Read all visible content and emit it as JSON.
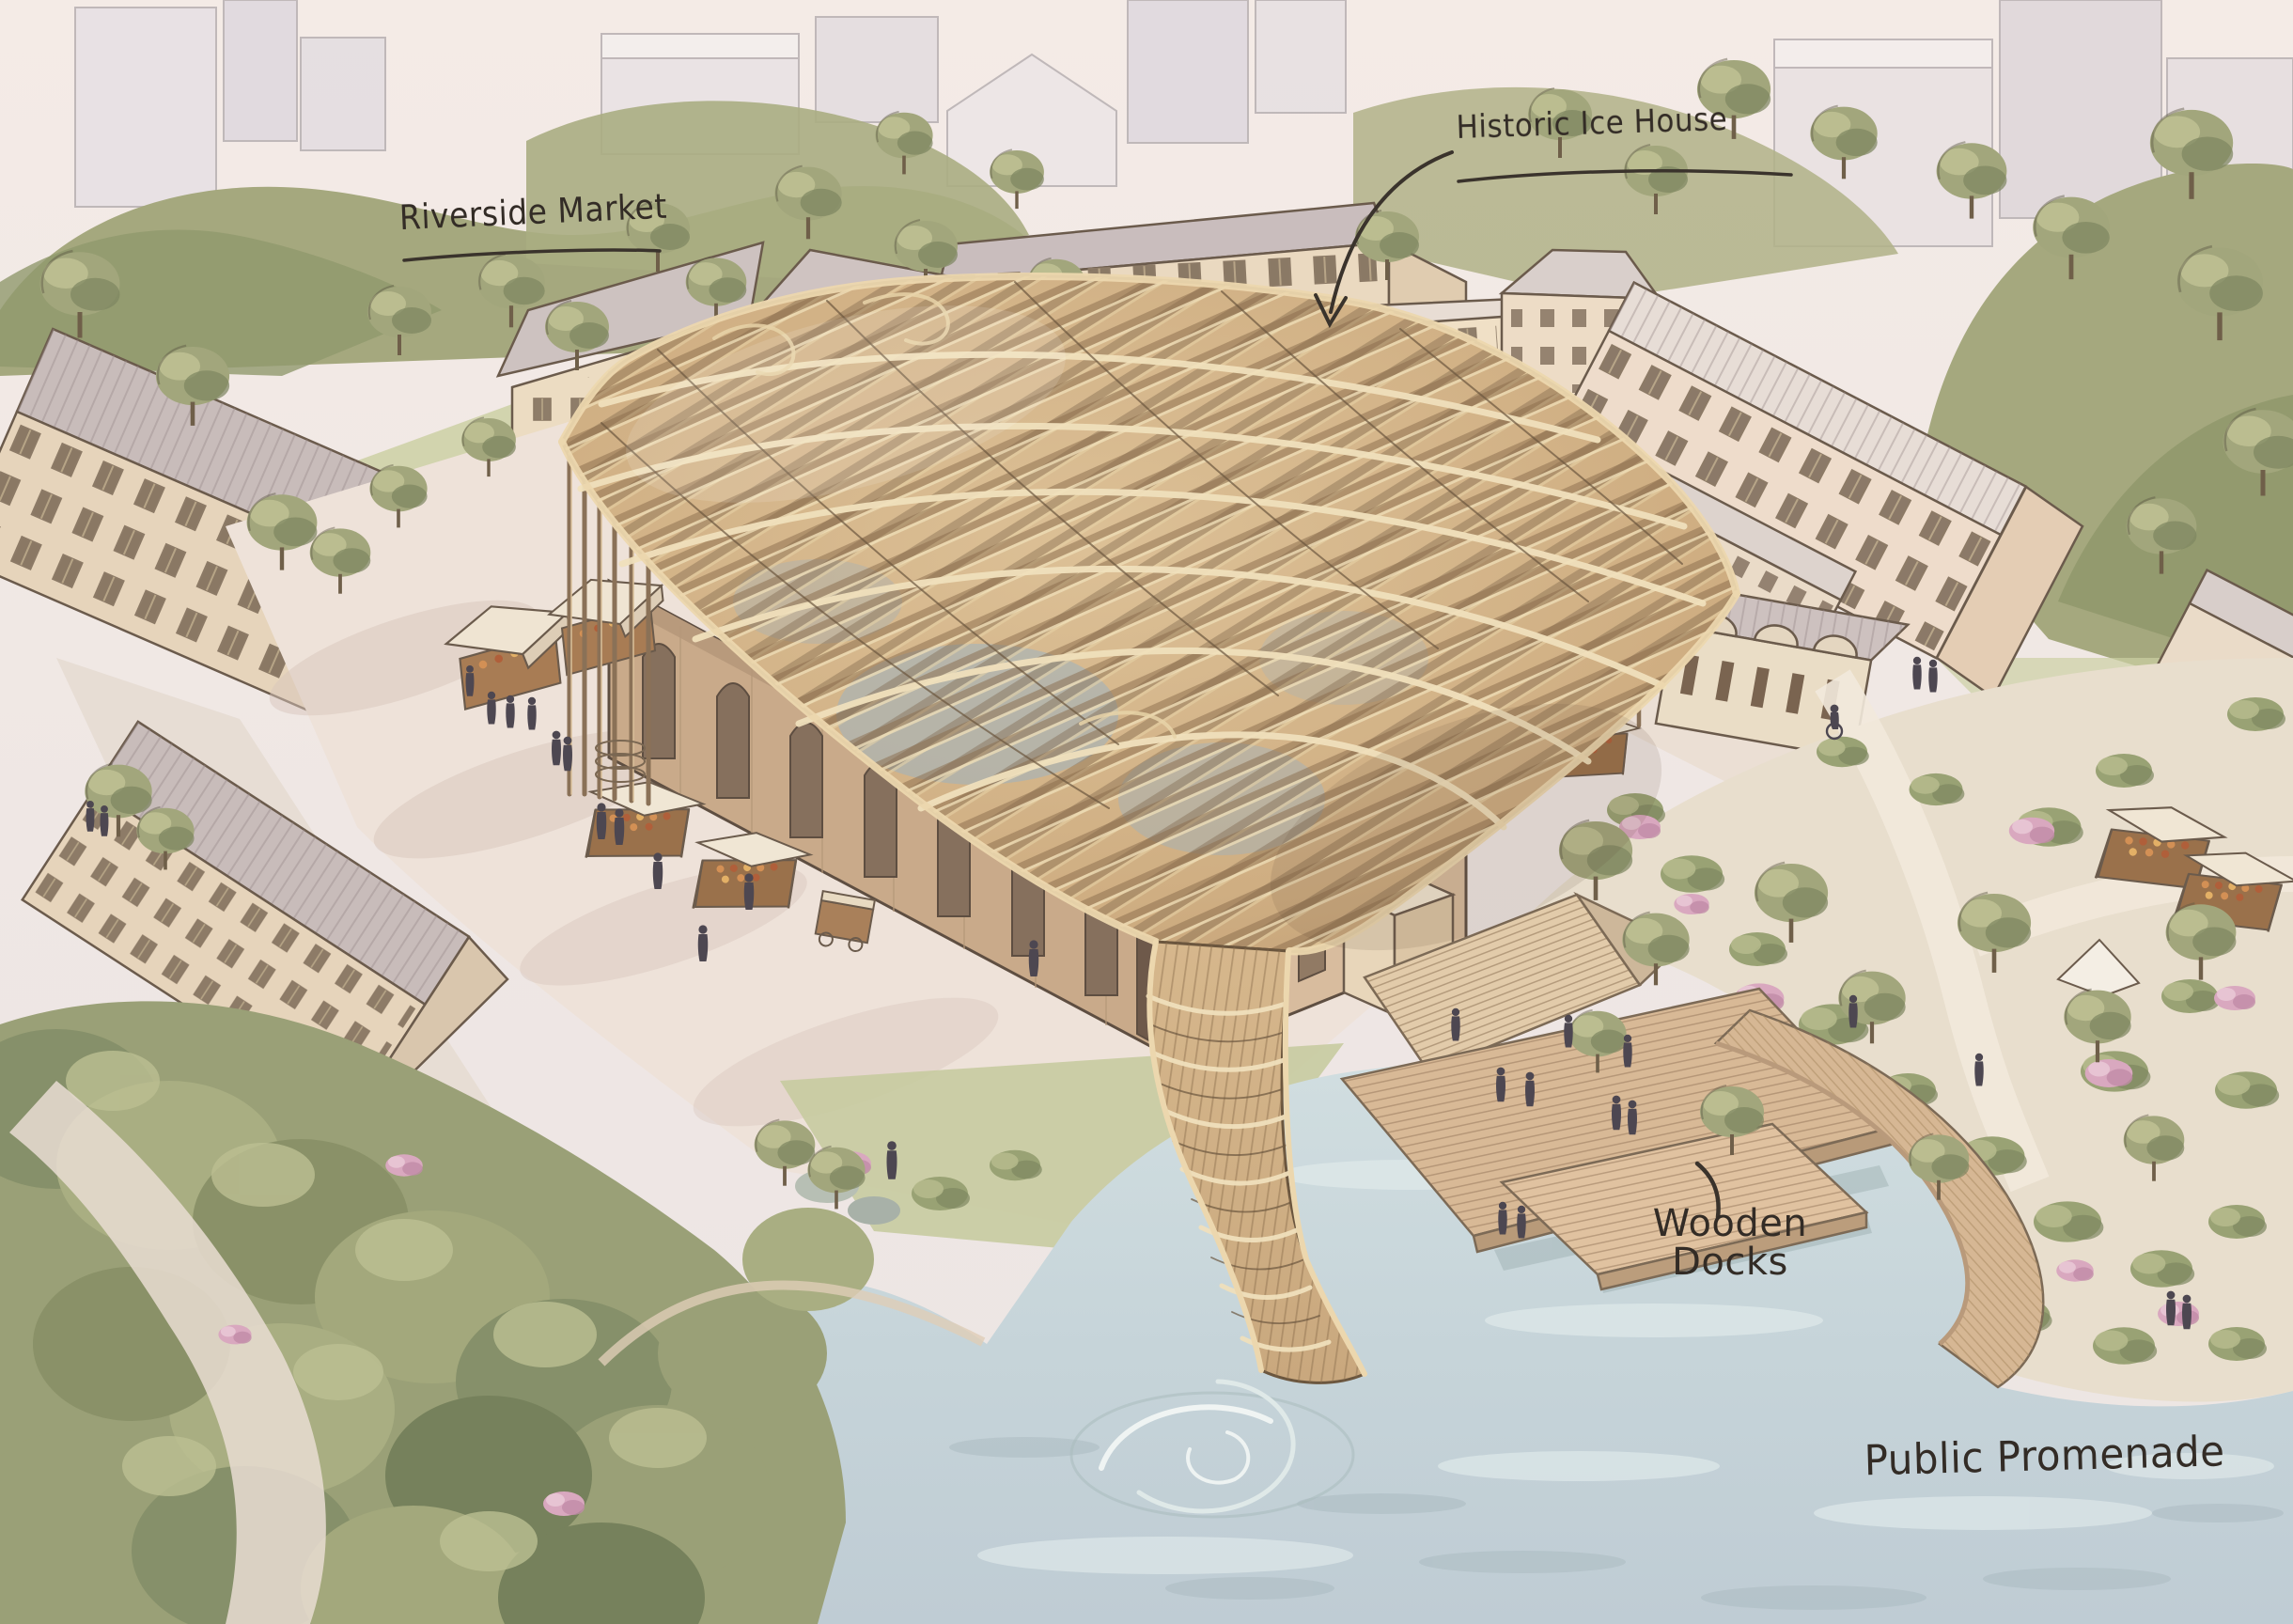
{
  "scene_type": "hand-drawn architectural masterplan illustration, aerial view",
  "labels": {
    "riverside_market": {
      "text": "Riverside Market"
    },
    "historic_ice_house": {
      "text": "Historic Ice House"
    },
    "wooden_docks": {
      "line1": "Wooden",
      "line2": "Docks"
    },
    "public_promenade": {
      "text": "Public Promenade"
    }
  },
  "palette": {
    "label_ink": "#332c26",
    "ink_line": "#6b5b4c",
    "canopy_wood": "#d2b284",
    "canopy_shadow": "#8a6d4e",
    "canopy_highlight": "#ecd7ae",
    "wall_cream": "#e8d8c0",
    "hall_tan": "#c9aa8a",
    "roof_grey": "#c8bcba",
    "water": "#c8d7da",
    "deck_wood": "#d6b794",
    "foliage": "#a2a67c",
    "foliage_dark": "#7e8761",
    "blossom_pink": "#d9a8bf",
    "path_cream": "#ece1d6"
  }
}
